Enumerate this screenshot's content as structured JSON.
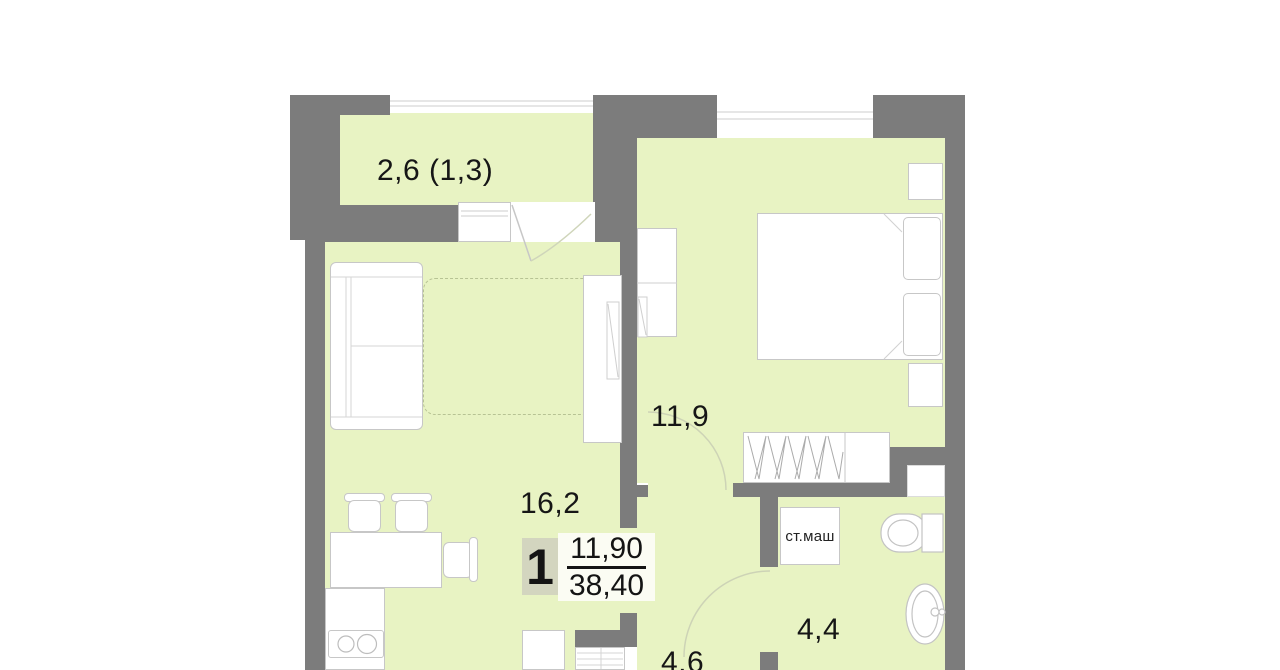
{
  "rooms": {
    "balcony": {
      "area": "2,6 (1,3)"
    },
    "living": {
      "area": "16,2"
    },
    "bedroom": {
      "area": "11,9"
    },
    "hall": {
      "area": "4,6"
    },
    "bathroom": {
      "area": "4,4"
    }
  },
  "badge": {
    "room_count": "1",
    "living_area": "11,90",
    "total_area": "38,40"
  },
  "appliances": {
    "washing_machine": "ст.маш"
  },
  "colors": {
    "room_fill": "#e8f3c3",
    "wall": "#7c7c7c",
    "furniture_line": "#c7c7c7",
    "badge_box": "#d3d5bf",
    "badge_panel": "#fbfcf3",
    "text": "#161616"
  }
}
